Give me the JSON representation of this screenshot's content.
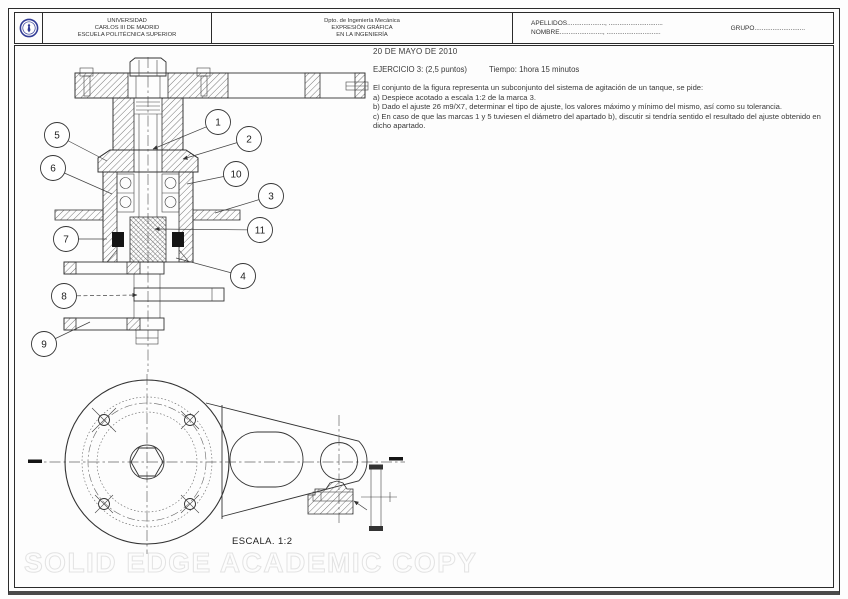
{
  "header": {
    "university": [
      "UNIVERSIDAD",
      "CARLOS III DE MADRID",
      "ESCUELA POLITÉCNICA SUPERIOR"
    ],
    "department": [
      "Dpto. de Ingeniería Mecánica",
      "EXPRESIÓN GRÁFICA",
      "EN LA INGENIERÍA"
    ],
    "apellidos": "APELLIDOS....................., ..............................",
    "nombre": "NOMBRE........................, ..............................",
    "grupo": "GRUPO............................",
    "logo_color": "#323c96"
  },
  "exam": {
    "date": "20 DE MAYO DE 2010",
    "exercise": "EJERCICIO 3: (2,5 puntos)",
    "time": "Tiempo: 1hora 15 minutos",
    "intro": "El conjunto de la figura representa un subconjunto del sistema de agitación de un tanque, se pide:",
    "item_a": "a) Despiece acotado a escala 1:2 de la marca 3.",
    "item_b": "b) Dado el ajuste 26 m9/X7, determinar el tipo de ajuste, los valores máximo y mínimo del mismo, así como su tolerancia.",
    "item_c": "c) En caso de que las marcas 1 y 5 tuviesen el diámetro del apartado b), discutir si tendría sentido el resultado del ajuste obtenido en dicho apartado."
  },
  "drawing": {
    "scale_label": "ESCALA. 1:2",
    "watermark": "SOLID EDGE ACADEMIC COPY",
    "line_color": "#333333",
    "balloons": [
      {
        "label": "1",
        "x": 218,
        "y": 122,
        "tx": 153,
        "ty": 149,
        "dashed": false,
        "arrow": true
      },
      {
        "label": "2",
        "x": 249,
        "y": 139,
        "tx": 183,
        "ty": 159,
        "dashed": false,
        "arrow": true
      },
      {
        "label": "10",
        "x": 236,
        "y": 174,
        "tx": 187,
        "ty": 184,
        "dashed": false,
        "arrow": false
      },
      {
        "label": "3",
        "x": 271,
        "y": 196,
        "tx": 215,
        "ty": 213,
        "dashed": false,
        "arrow": false
      },
      {
        "label": "11",
        "x": 260,
        "y": 230,
        "tx": 155,
        "ty": 229,
        "dashed": false,
        "arrow": true
      },
      {
        "label": "4",
        "x": 243,
        "y": 276,
        "tx": 176,
        "ty": 258,
        "dashed": false,
        "arrow": false
      },
      {
        "label": "5",
        "x": 57,
        "y": 135,
        "tx": 107,
        "ty": 161,
        "dashed": false,
        "arrow": false
      },
      {
        "label": "6",
        "x": 53,
        "y": 168,
        "tx": 112,
        "ty": 194,
        "dashed": false,
        "arrow": false
      },
      {
        "label": "7",
        "x": 66,
        "y": 239,
        "tx": 107,
        "ty": 239,
        "dashed": false,
        "arrow": false
      },
      {
        "label": "8",
        "x": 64,
        "y": 296,
        "tx": 137,
        "ty": 295,
        "dashed": true,
        "arrow": true
      },
      {
        "label": "9",
        "x": 44,
        "y": 344,
        "tx": 90,
        "ty": 322,
        "dashed": false,
        "arrow": false
      }
    ]
  }
}
